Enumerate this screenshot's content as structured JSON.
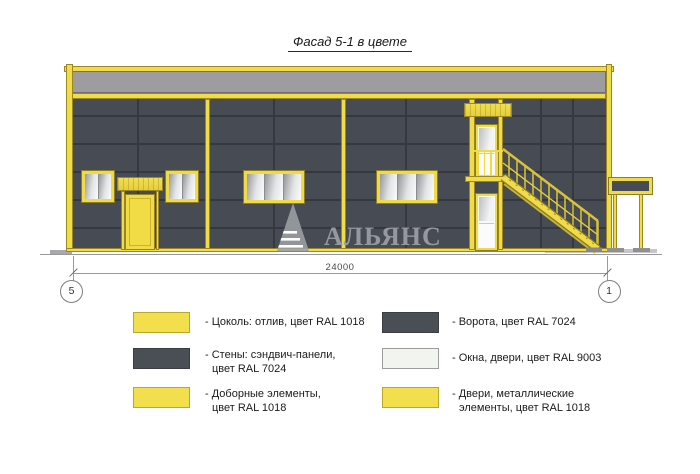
{
  "title": "Фасад 5-1 в цвете",
  "watermark": {
    "text": "АЛЬЯНС"
  },
  "dimension": {
    "value": "24000",
    "axis_left": "5",
    "axis_right": "1"
  },
  "colors": {
    "ral_1018_yellow": "#F0DB49",
    "ral_7024_wall": "#474B53",
    "ral_9003_white": "#F2F5EF",
    "parapet_gray": "#9D9DA0"
  },
  "legend": {
    "items": [
      {
        "swatch": "#F3DF4D",
        "line1": "- Цоколь: отлив, цвет RAL 1018",
        "line2": ""
      },
      {
        "swatch": "#4A4E55",
        "line1": "- Стены: сэндвич-панели,",
        "line2": "цвет RAL 7024"
      },
      {
        "swatch": "#F3DF4D",
        "line1": "- Доборные элементы,",
        "line2": "цвет RAL 1018"
      },
      {
        "swatch": "#4A4E55",
        "line1": "- Ворота, цвет RAL 7024",
        "line2": ""
      },
      {
        "swatch": "#F2F5EF",
        "line1": "- Окна, двери, цвет RAL 9003",
        "line2": ""
      },
      {
        "swatch": "#F3DF4D",
        "line1": "- Двери, металлические",
        "line2": "элементы, цвет RAL 1018"
      }
    ]
  }
}
